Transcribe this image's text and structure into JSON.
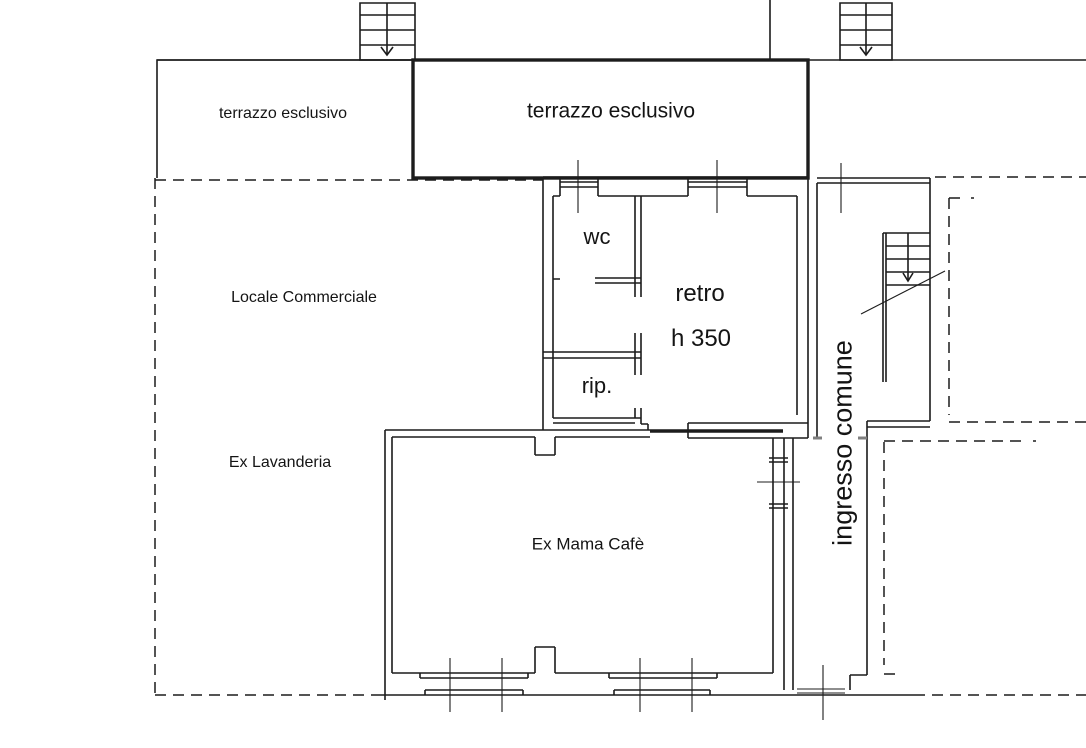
{
  "labels": {
    "terrace_left": "terrazzo esclusivo",
    "terrace_main": "terrazzo esclusivo",
    "locale_commerciale": "Locale Commerciale",
    "ex_lavanderia": "Ex Lavanderia",
    "wc": "wc",
    "retro": "retro",
    "retro_height": "h 350",
    "rip": "rip.",
    "ex_mama_cafe": "Ex Mama Cafè",
    "ingresso_comune": "ingresso comune"
  },
  "colors": {
    "line": "#1c1c1c",
    "door_mark": "#808080",
    "background": "#ffffff"
  }
}
